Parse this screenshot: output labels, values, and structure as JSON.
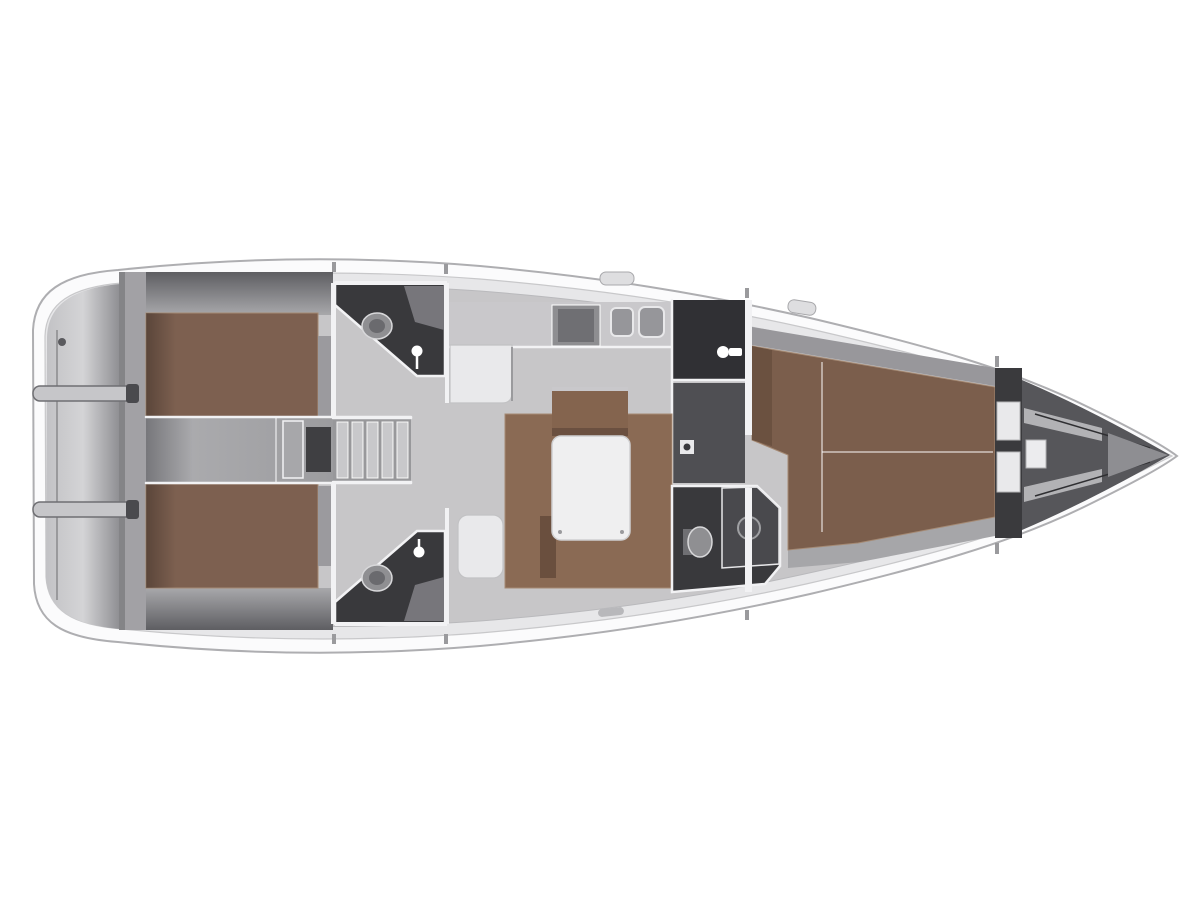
{
  "canvas": {
    "width": 1200,
    "height": 900
  },
  "figure_type": "sailing-yacht-interior-floor-plan",
  "palette": {
    "background": "#ffffff",
    "hull_fill": "#fbfbfc",
    "hull_stroke": "#aeaeb1",
    "deck_fill": "#e7e7e9",
    "deck_stroke": "#c8c8ca",
    "floor": "#c7c6c8",
    "lazarette": "#a2a1a5",
    "berth": "#7d6050",
    "fwd_berth": "#7b5e4c",
    "berth_dark": "#6b5140",
    "berth_seam": "#a58a74",
    "sofa": "#8a6a54",
    "sofa_dark": "#6a4f3e",
    "backrest": "#84644e",
    "table": "#efeff0",
    "seat_white": "#e9e9eb",
    "dark_room": "#39393c",
    "dark_room2": "#4a4a4e",
    "locker_dark": "#303034",
    "locker_mid": "#4f4f53",
    "fixture": "#8f8f92",
    "fixture_dark": "#6f6f73",
    "counter": "#c9c8cb",
    "step_bg": "#98989b",
    "step": "#c8c8cb",
    "wall_white": "#f2f2f4",
    "forepeak": "#56565a",
    "beam": "#b2b2b5",
    "side_band": "#98979b",
    "wheel": "#c6c6c9"
  },
  "features": {
    "stern": [
      "swim-platform",
      "steering-wheel-icon",
      "steering-wheel-icon",
      "backstay-line",
      "lazarette"
    ],
    "aft_cabins": [
      "aft-berth-port",
      "aft-berth-starboard",
      "engine-compartment"
    ],
    "companionway": [
      "companionway-steps"
    ],
    "aft_head_port": [
      "toilet-icon",
      "shower-mixer-icon",
      "sink-unit"
    ],
    "aft_head_starboard": [
      "toilet-icon",
      "shower-mixer-icon",
      "sink-unit"
    ],
    "galley": [
      "counter",
      "l-counter",
      "stove-icon",
      "sink-icon",
      "sink-icon",
      "tall-locker",
      "faucet-icon"
    ],
    "salon": [
      "u-sofa",
      "salon-table",
      "backrest",
      "nav-seat"
    ],
    "forward_head": [
      "toilet-icon",
      "shower-pan-icon"
    ],
    "forward_cabin": [
      "v-berth",
      "wardrobe",
      "door-handle"
    ],
    "bow": [
      "collision-bulkhead",
      "anchor-locker",
      "bow-tip"
    ],
    "deck": [
      "deck-hatch",
      "deck-hatch",
      "cleat"
    ]
  }
}
